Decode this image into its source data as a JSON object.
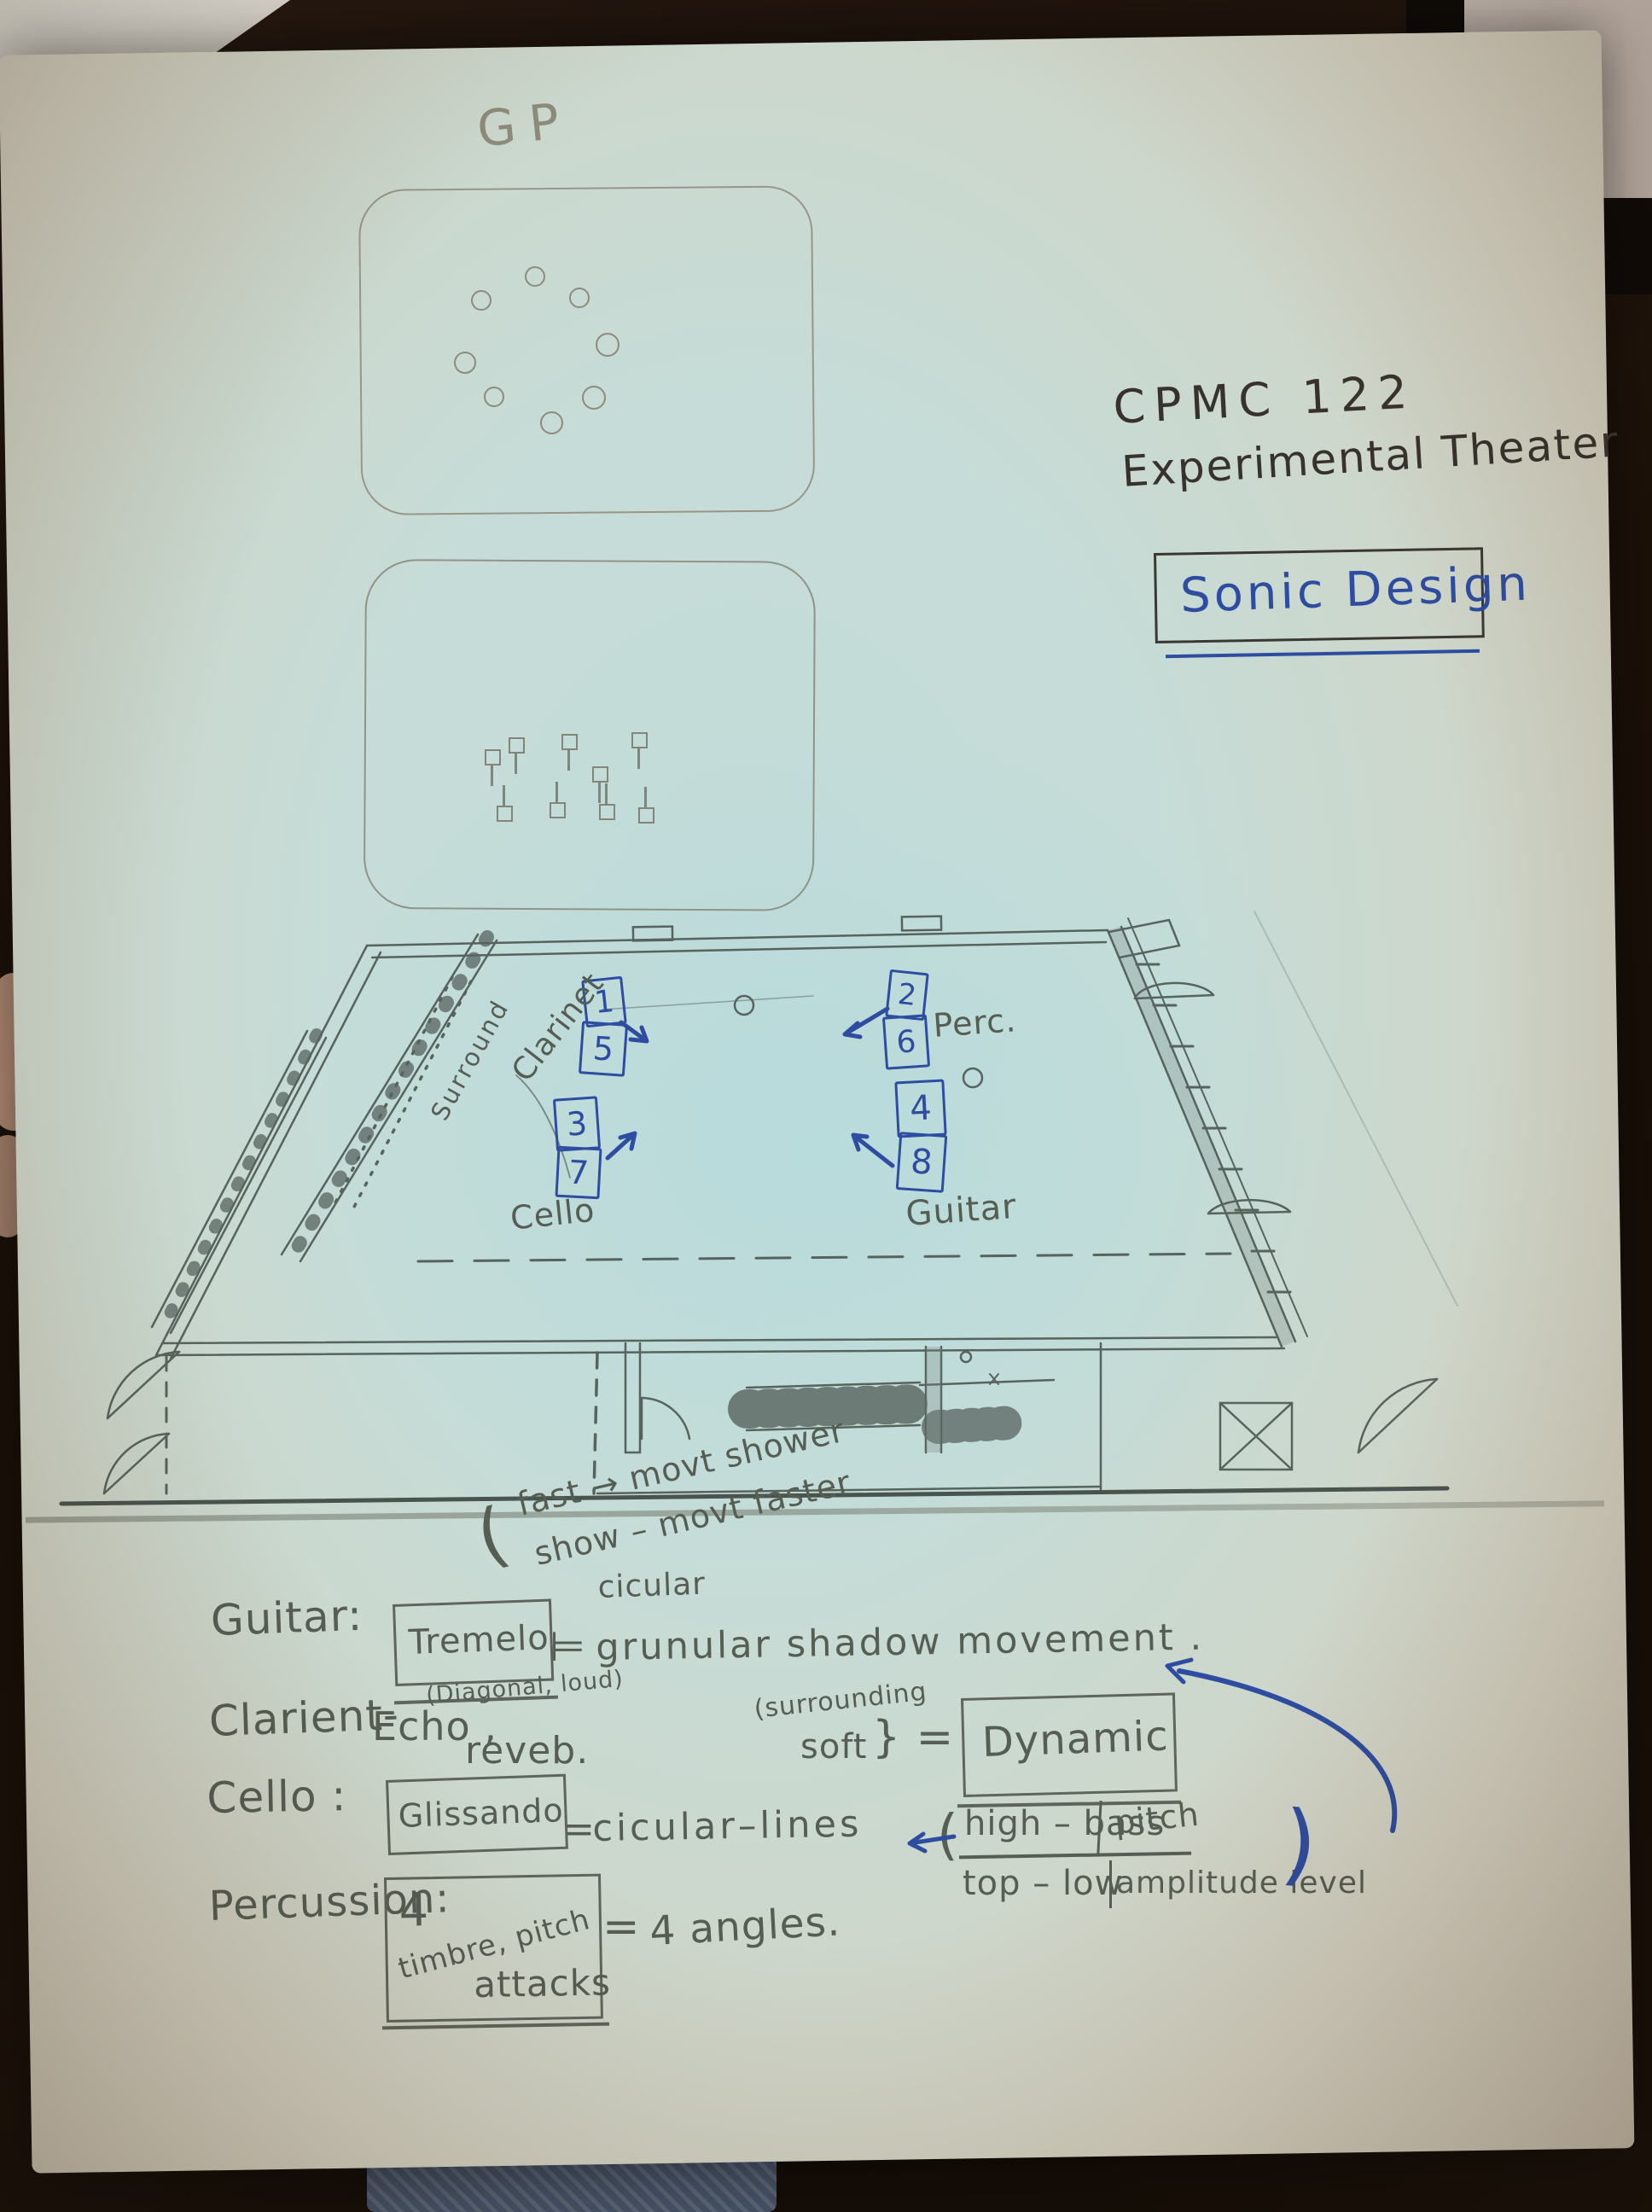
{
  "colors": {
    "background": "#190f08",
    "paper_center": "#c3dbd8",
    "paper_edge": "#d3cbba",
    "pencil": "#565d53",
    "ink": "#37322c",
    "blue_pen": "#2e4da0"
  },
  "sketches": {
    "gp_label": "GP"
  },
  "title": {
    "line1": "CPMC 122",
    "line2": "Experimental Theater",
    "badge": "Sonic Design"
  },
  "plan": {
    "clarinet_label": "Clarinet",
    "clarinet_top": "1",
    "clarinet_bottom": "5",
    "perc_label": "Perc.",
    "perc_top": "2",
    "perc_bottom": "6",
    "cello_label": "Cello",
    "cello_top": "3",
    "cello_bottom": "7",
    "guitar_label": "Guitar",
    "guitar_top": "4",
    "guitar_bottom": "8",
    "surround_note": "Surround",
    "tempo_brace": "(",
    "tempo_line1": "fast → movt shower",
    "tempo_line2": "show – movt faster"
  },
  "notes": {
    "guitar_label": "Guitar:",
    "guitar_box": "Tremelo",
    "guitar_eq": "⊨",
    "guitar_above": "cicular",
    "guitar_text": "grunular shadow movement .",
    "clarinet_label": "Clarient-",
    "clarinet_echo": "Echo ,",
    "clarinet_sup": "(Diagonal, loud)",
    "clarinet_reverb": "reveb.",
    "clarinet_surrounding": "(surrounding",
    "clarinet_soft": "soft",
    "clarinet_brace": "} =",
    "clarinet_box": "Dynamic",
    "cello_label": "Cello  :",
    "cello_box": "Glissando",
    "cello_eq": "=",
    "cello_text": "cicular–lines",
    "frac_open": "(",
    "frac_tl": "high – bass",
    "frac_tr": "pitch",
    "frac_bl": "top – low",
    "frac_br": "amplitude level",
    "frac_close": ")",
    "perc_label": "Percussion:",
    "perc_num": "4",
    "perc_diag": "timbre, pitch",
    "perc_attacks": "attacks",
    "perc_eq": "=",
    "perc_text": "4  angles."
  }
}
